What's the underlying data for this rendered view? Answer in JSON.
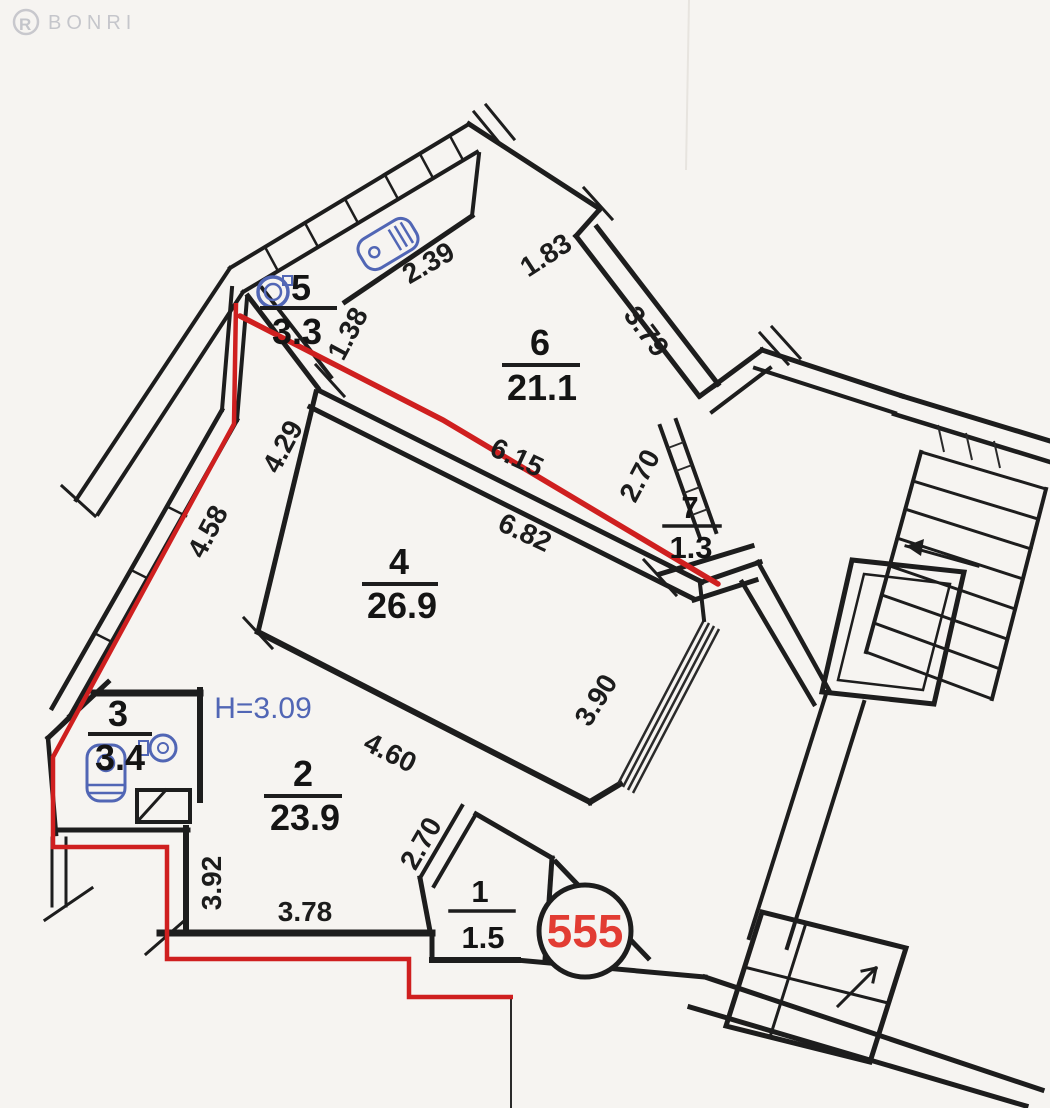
{
  "document": {
    "watermark": "BONRI"
  },
  "plan": {
    "unit_number": "555",
    "ceiling_height_label": "H=3.09",
    "rooms": [
      {
        "number": "5",
        "area": "3.3"
      },
      {
        "number": "6",
        "area": "21.1"
      },
      {
        "number": "7",
        "area": "1.3"
      },
      {
        "number": "4",
        "area": "26.9"
      },
      {
        "number": "3",
        "area": "3.4"
      },
      {
        "number": "2",
        "area": "23.9"
      },
      {
        "number": "1",
        "area": "1.5"
      }
    ],
    "dimensions": [
      "2.39",
      "1.83",
      "3.79",
      "1.38",
      "4.29",
      "4.58",
      "6.15",
      "6.82",
      "2.70",
      "3.90",
      "4.60",
      "2.70",
      "3.92",
      "3.78"
    ],
    "colors": {
      "wall": "#1d1d1d",
      "red_boundary": "#cf1f1f",
      "fixtures_blue": "#5166b5",
      "unit_number_red": "#e23c33",
      "paper": "#f6f4f1"
    }
  }
}
